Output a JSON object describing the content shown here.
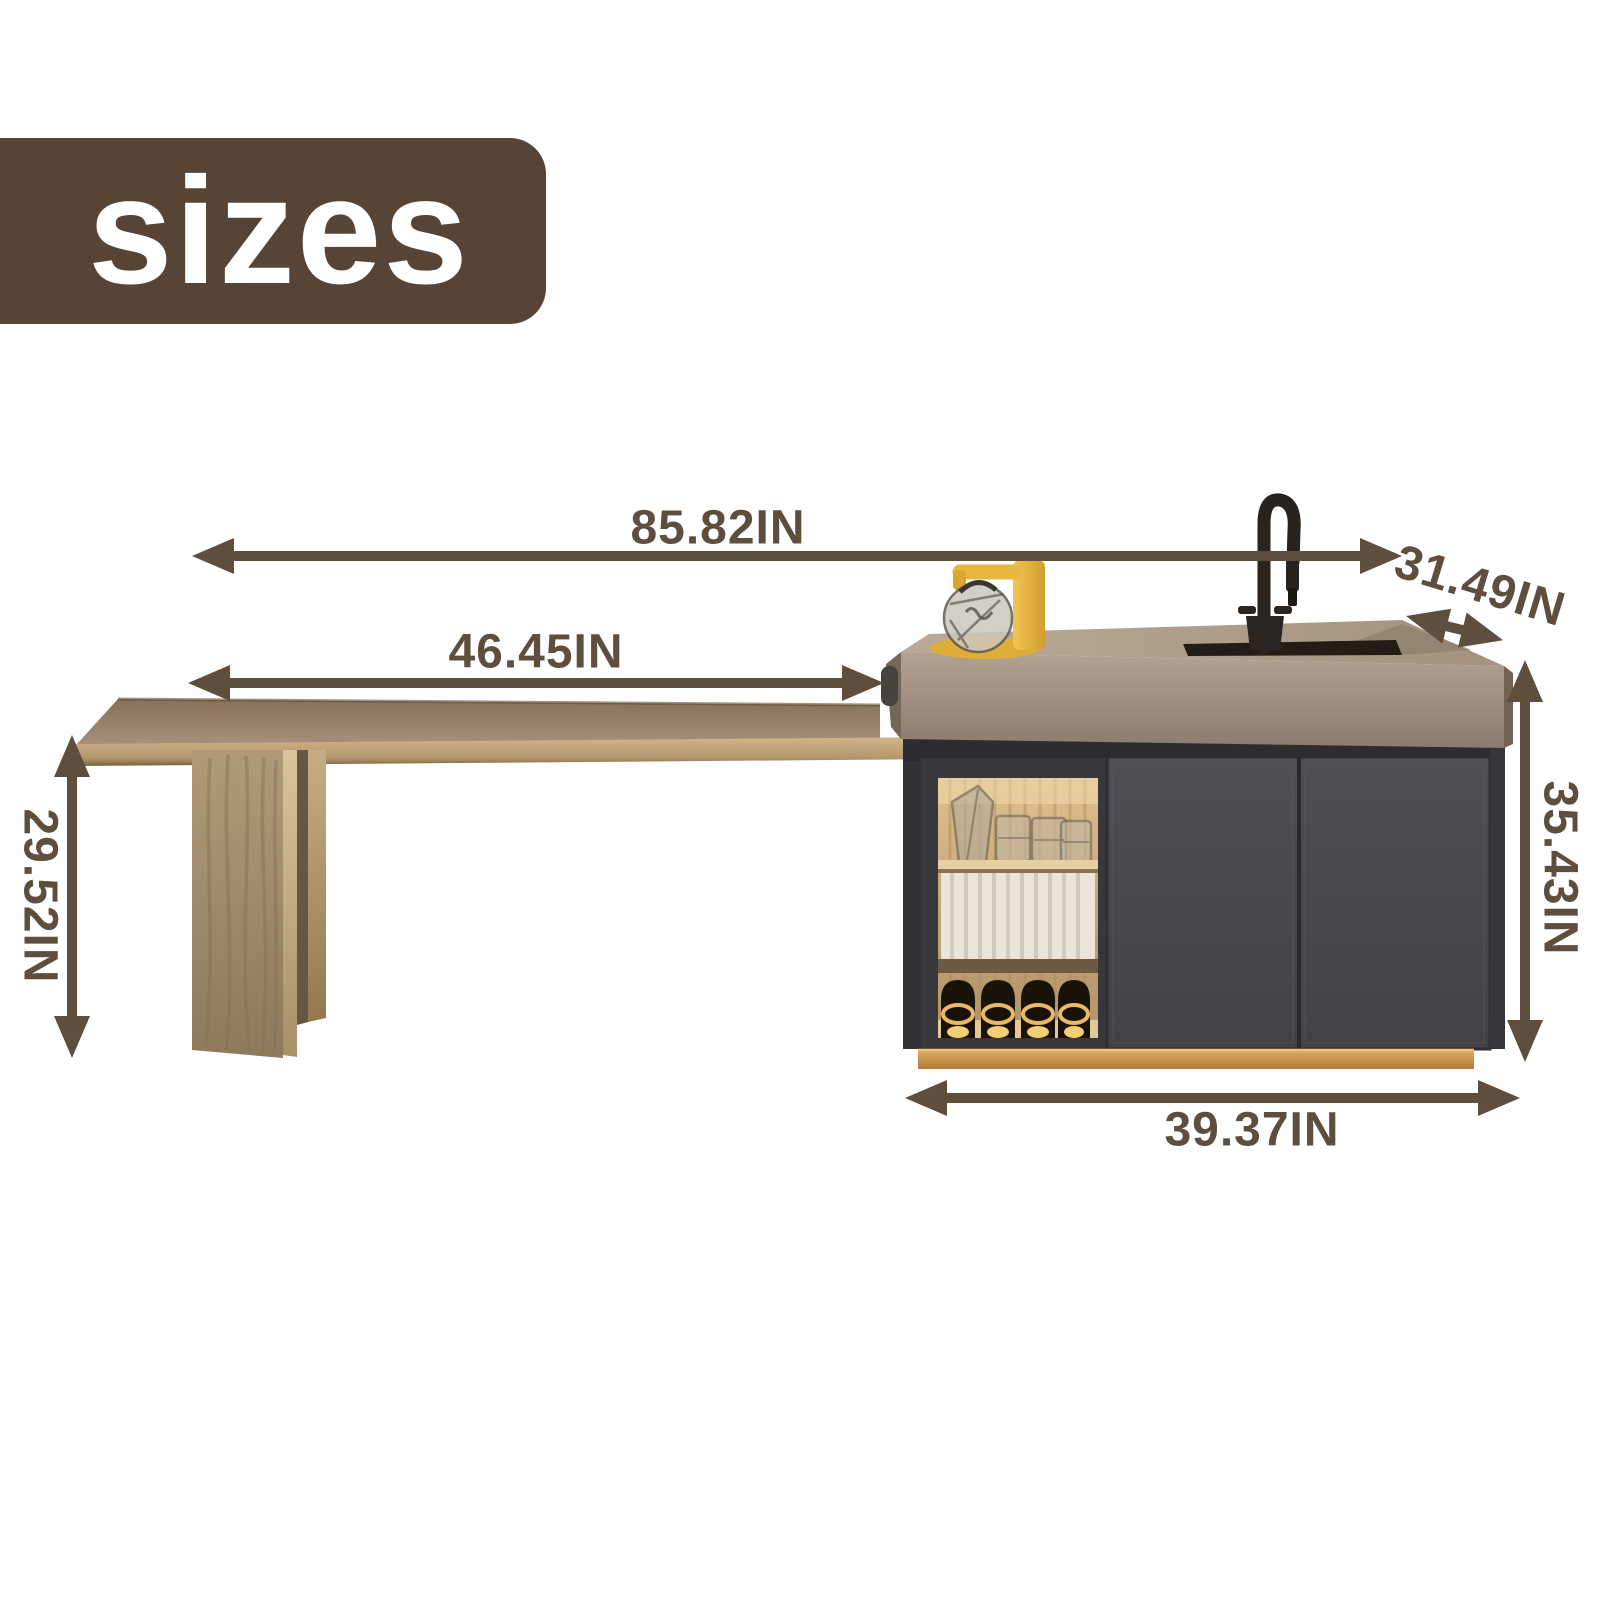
{
  "title_badge": {
    "label": "sizes"
  },
  "dimensions": {
    "overall_width": {
      "label": "85.82IN",
      "value": 85.82,
      "unit": "IN"
    },
    "table_length": {
      "label": "46.45IN",
      "value": 46.45,
      "unit": "IN"
    },
    "island_depth": {
      "label": "31.49IN",
      "value": 31.49,
      "unit": "IN"
    },
    "table_height": {
      "label": "29.52IN",
      "value": 29.52,
      "unit": "IN"
    },
    "island_height": {
      "label": "35.43IN",
      "value": 35.43,
      "unit": "IN"
    },
    "island_width": {
      "label": "39.37IN",
      "value": 39.37,
      "unit": "IN"
    }
  },
  "colors": {
    "dimension_annotation": "#5d4e3e",
    "badge_background": "#564537",
    "badge_text": "#ffffff",
    "countertop": "#a89883",
    "cabinet": "#46454a",
    "table_wood": "#c5a97e",
    "plinth_gold": "#cf9a50",
    "accent_yellow": "#e8b83e",
    "background": "#ffffff"
  },
  "illustration_parts": [
    "dining-table-top",
    "table-leg",
    "kitchen-island-countertop",
    "sink",
    "faucet",
    "display-niche",
    "glassware",
    "curtain-panel",
    "wine-bottles",
    "cabinet-doors",
    "gold-plinth",
    "teapot-decor",
    "yellow-tap-decor"
  ]
}
